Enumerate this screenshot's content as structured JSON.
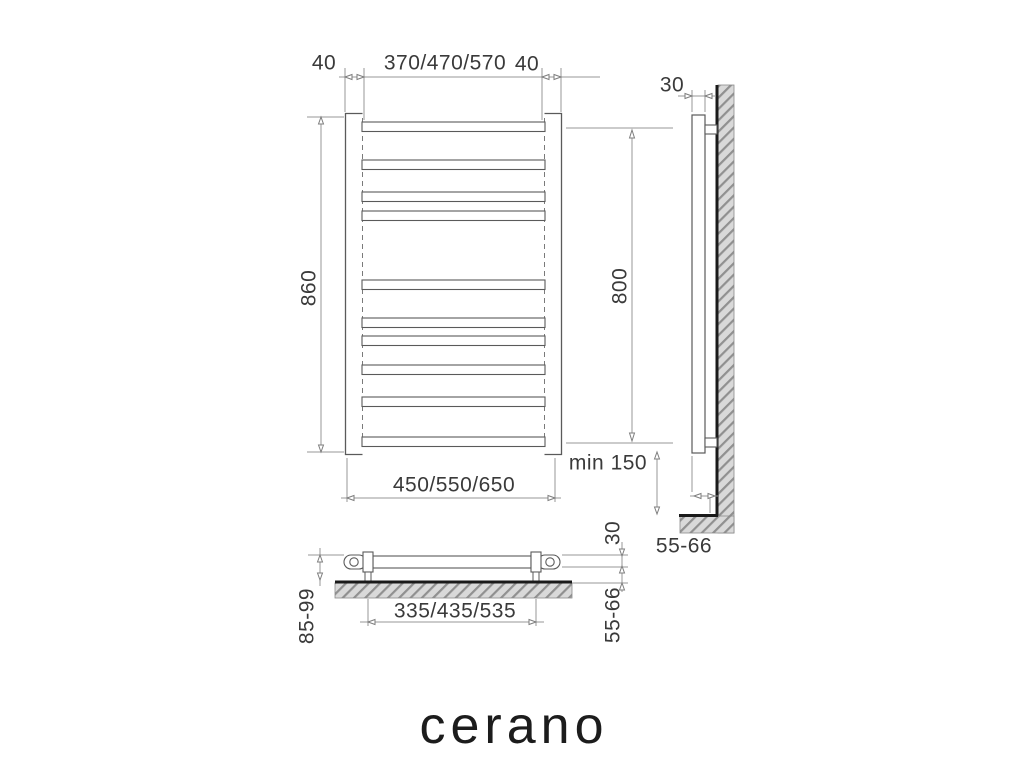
{
  "logo": {
    "text": "cerano"
  },
  "front_view": {
    "dims": {
      "left_offset": "40",
      "rail_width": "370/470/570",
      "right_offset": "40",
      "height": "860",
      "overall_width": "450/550/650"
    }
  },
  "side_view": {
    "dims": {
      "tube_depth": "30",
      "bracket_height": "800",
      "floor_clearance": "min 150",
      "wall_distance": "55-66"
    }
  },
  "top_view": {
    "dims": {
      "bracket_spacing": "335/435/535",
      "overall_depth": "85-99",
      "tube_depth": "30",
      "wall_gap": "55-66"
    }
  },
  "colors": {
    "object_line": "#5a5a5a",
    "dim_line": "#979797",
    "text": "#3a3a3a",
    "wall_fill": "#d9d9d9",
    "wall_hatch": "#909090",
    "wall_edge": "#1a1a1a"
  }
}
